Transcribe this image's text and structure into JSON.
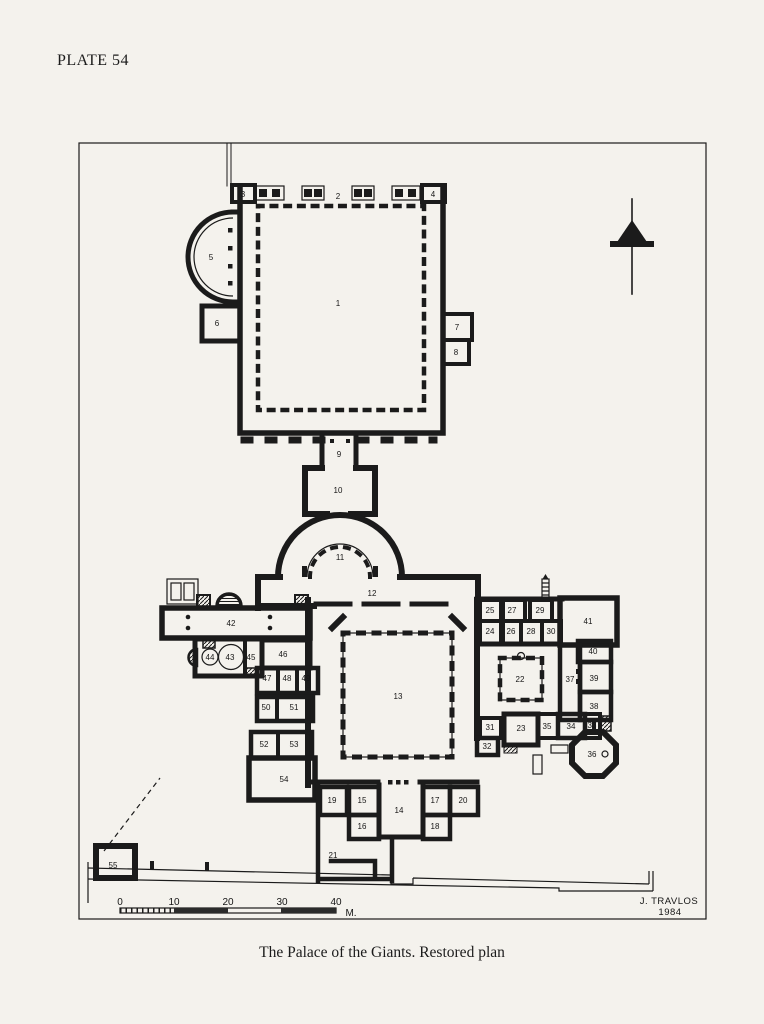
{
  "page": {
    "plate_label": "PLATE 54",
    "caption": "The Palace of the Giants. Restored plan"
  },
  "plan": {
    "attribution": {
      "author": "J. TRAVLOS",
      "year": "1984"
    },
    "scale_bar": {
      "ticks": [
        "0",
        "10",
        "20",
        "30",
        "40"
      ],
      "unit": "M."
    },
    "colors": {
      "ink": "#1b1b1b",
      "paper": "#f4f2ed"
    },
    "icons": {
      "north_arrow": "north-arrow"
    },
    "rooms": [
      "1",
      "2",
      "3",
      "4",
      "5",
      "6",
      "7",
      "8",
      "9",
      "10",
      "11",
      "12",
      "13",
      "14",
      "15",
      "16",
      "17",
      "18",
      "19",
      "20",
      "21",
      "22",
      "23",
      "24",
      "25",
      "26",
      "27",
      "28",
      "29",
      "30",
      "31",
      "32",
      "33",
      "34",
      "35",
      "36",
      "37",
      "38",
      "39",
      "40",
      "41",
      "42",
      "43",
      "44",
      "45",
      "46",
      "47",
      "48",
      "49",
      "50",
      "51",
      "52",
      "53",
      "54",
      "55"
    ]
  }
}
